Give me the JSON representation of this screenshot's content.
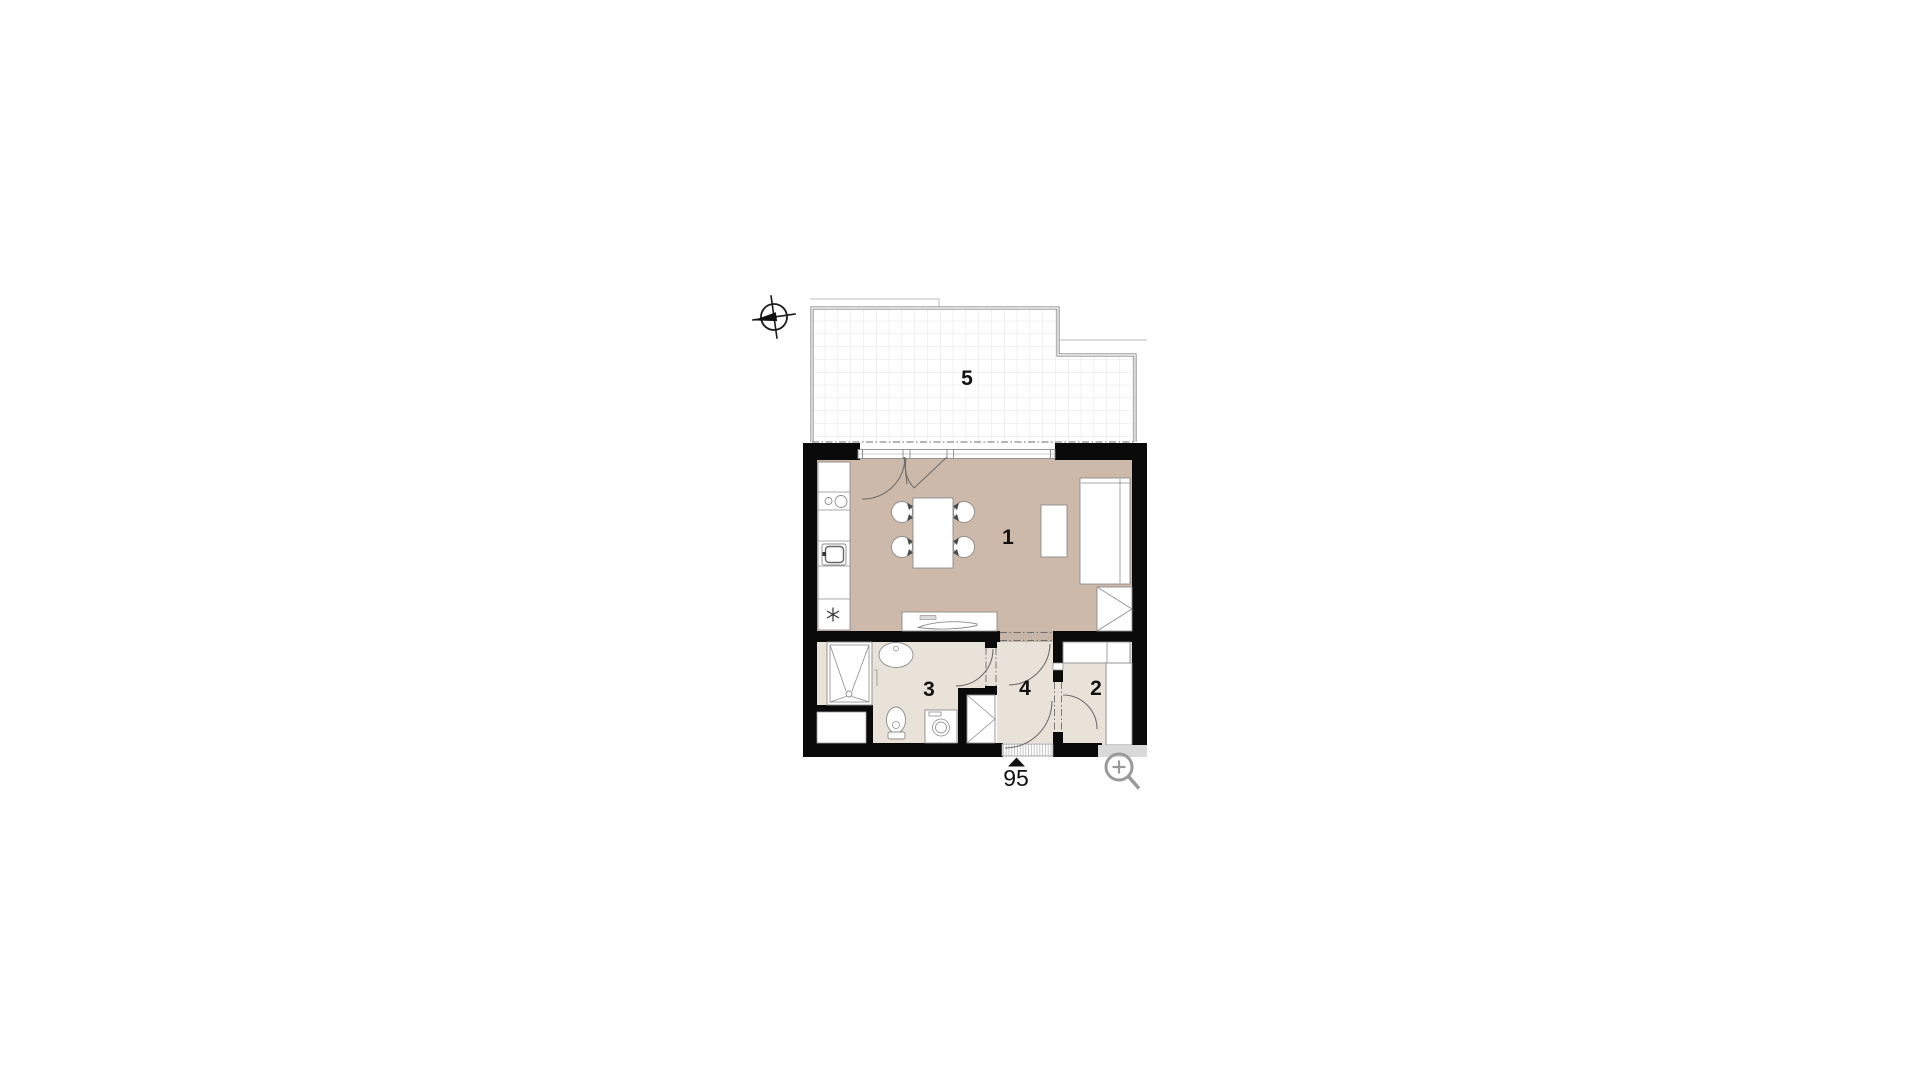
{
  "colors": {
    "wall": "#0a0a0a",
    "floor_main": "#ccb9aa",
    "floor_light": "#e9e2d9",
    "railing": "#6f6f6f",
    "outer_line": "#bcbcbc",
    "grid": "#e4e4e4",
    "fixture": "#8c8c8c",
    "door": "#6e6e6e",
    "label": "#111111",
    "overlay_strip": "#d9d9d9",
    "magnifier": "#9a9a9a"
  },
  "rooms": [
    {
      "label": "1"
    },
    {
      "label": "2"
    },
    {
      "label": "3"
    },
    {
      "label": "4"
    },
    {
      "label": "5"
    }
  ],
  "entrance": {
    "number": "95"
  },
  "icons": {
    "compass": "north-indicator",
    "magnifier": "zoom-in"
  }
}
